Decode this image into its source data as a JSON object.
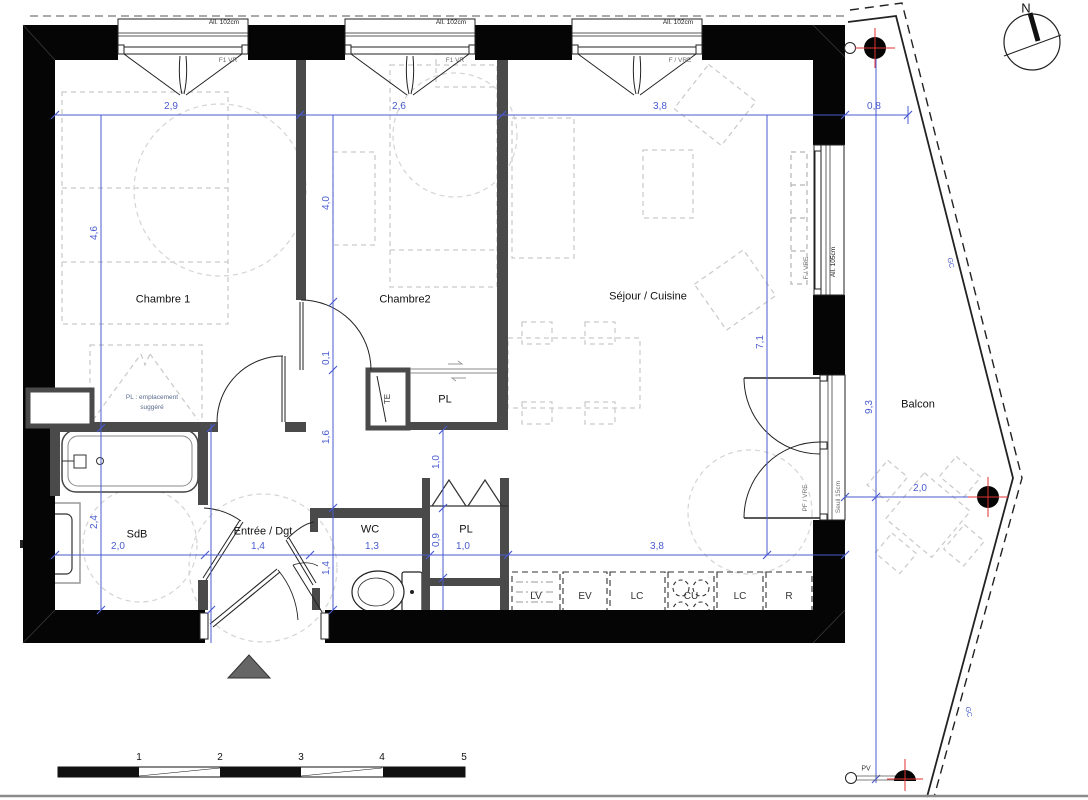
{
  "plan": {
    "rooms": {
      "chambre1": "Chambre 1",
      "chambre2": "Chambre2",
      "sejour": "Séjour / Cuisine",
      "sdb": "SdB",
      "entree": "Entrée / Dgt",
      "wc": "WC",
      "pl_hall": "PL",
      "pl_entree": "PL",
      "te": "TE",
      "balcon": "Balcon"
    },
    "annotations": {
      "pl_note_line1": "PL : emplacement",
      "pl_note_line2": "suggéré",
      "gc_upper": "GC",
      "gc_lower": "GC",
      "pv": "PV",
      "north": "N"
    },
    "windows": {
      "w1": {
        "sill": "All. 102cm",
        "type": "F1 VR"
      },
      "w2": {
        "sill": "All. 102cm",
        "type": "F1 VR"
      },
      "w3": {
        "sill": "All. 102cm",
        "type": "F / VRE"
      },
      "right_window": {
        "sill": "All. 105cm",
        "type": "F / VRE"
      },
      "balcony_door": {
        "type": "PF / VRE",
        "threshold": "Seuil 15cm"
      }
    },
    "dimensions": {
      "top": {
        "chambre1_width": "2,9",
        "chambre2_width": "2,6",
        "sejour_width": "3,8",
        "balcony_offset": "0,8"
      },
      "left": {
        "chambre1_depth": "4,6",
        "sdb_depth": "2,4"
      },
      "middle": {
        "chambre2_depth": "4,0",
        "door_offset": "0,1",
        "hall_depth": "1,6",
        "hall_lower": "1,4",
        "pl_front": "1,0",
        "pl_depth": "0,9"
      },
      "bottom": {
        "sdb_width": "2,0",
        "entree_width": "1,4",
        "wc_width": "1,3",
        "pl_width": "1,0",
        "kitchen_width": "3,8"
      },
      "sejour_depth": "7,1",
      "balcony": {
        "length": "9,3",
        "width": "2,0"
      }
    },
    "kitchen_units": [
      "LV",
      "EV",
      "LC",
      "CU",
      "LC",
      "R"
    ],
    "scale_bar": [
      "1",
      "2",
      "3",
      "4",
      "5"
    ]
  },
  "colors": {
    "wall_black": "#050505",
    "partition_gray": "#4a4a4a",
    "dimension_blue": "#4a5bd0",
    "drain_marker_red": "#e03131",
    "furniture_gray": "#c9c9c9"
  }
}
